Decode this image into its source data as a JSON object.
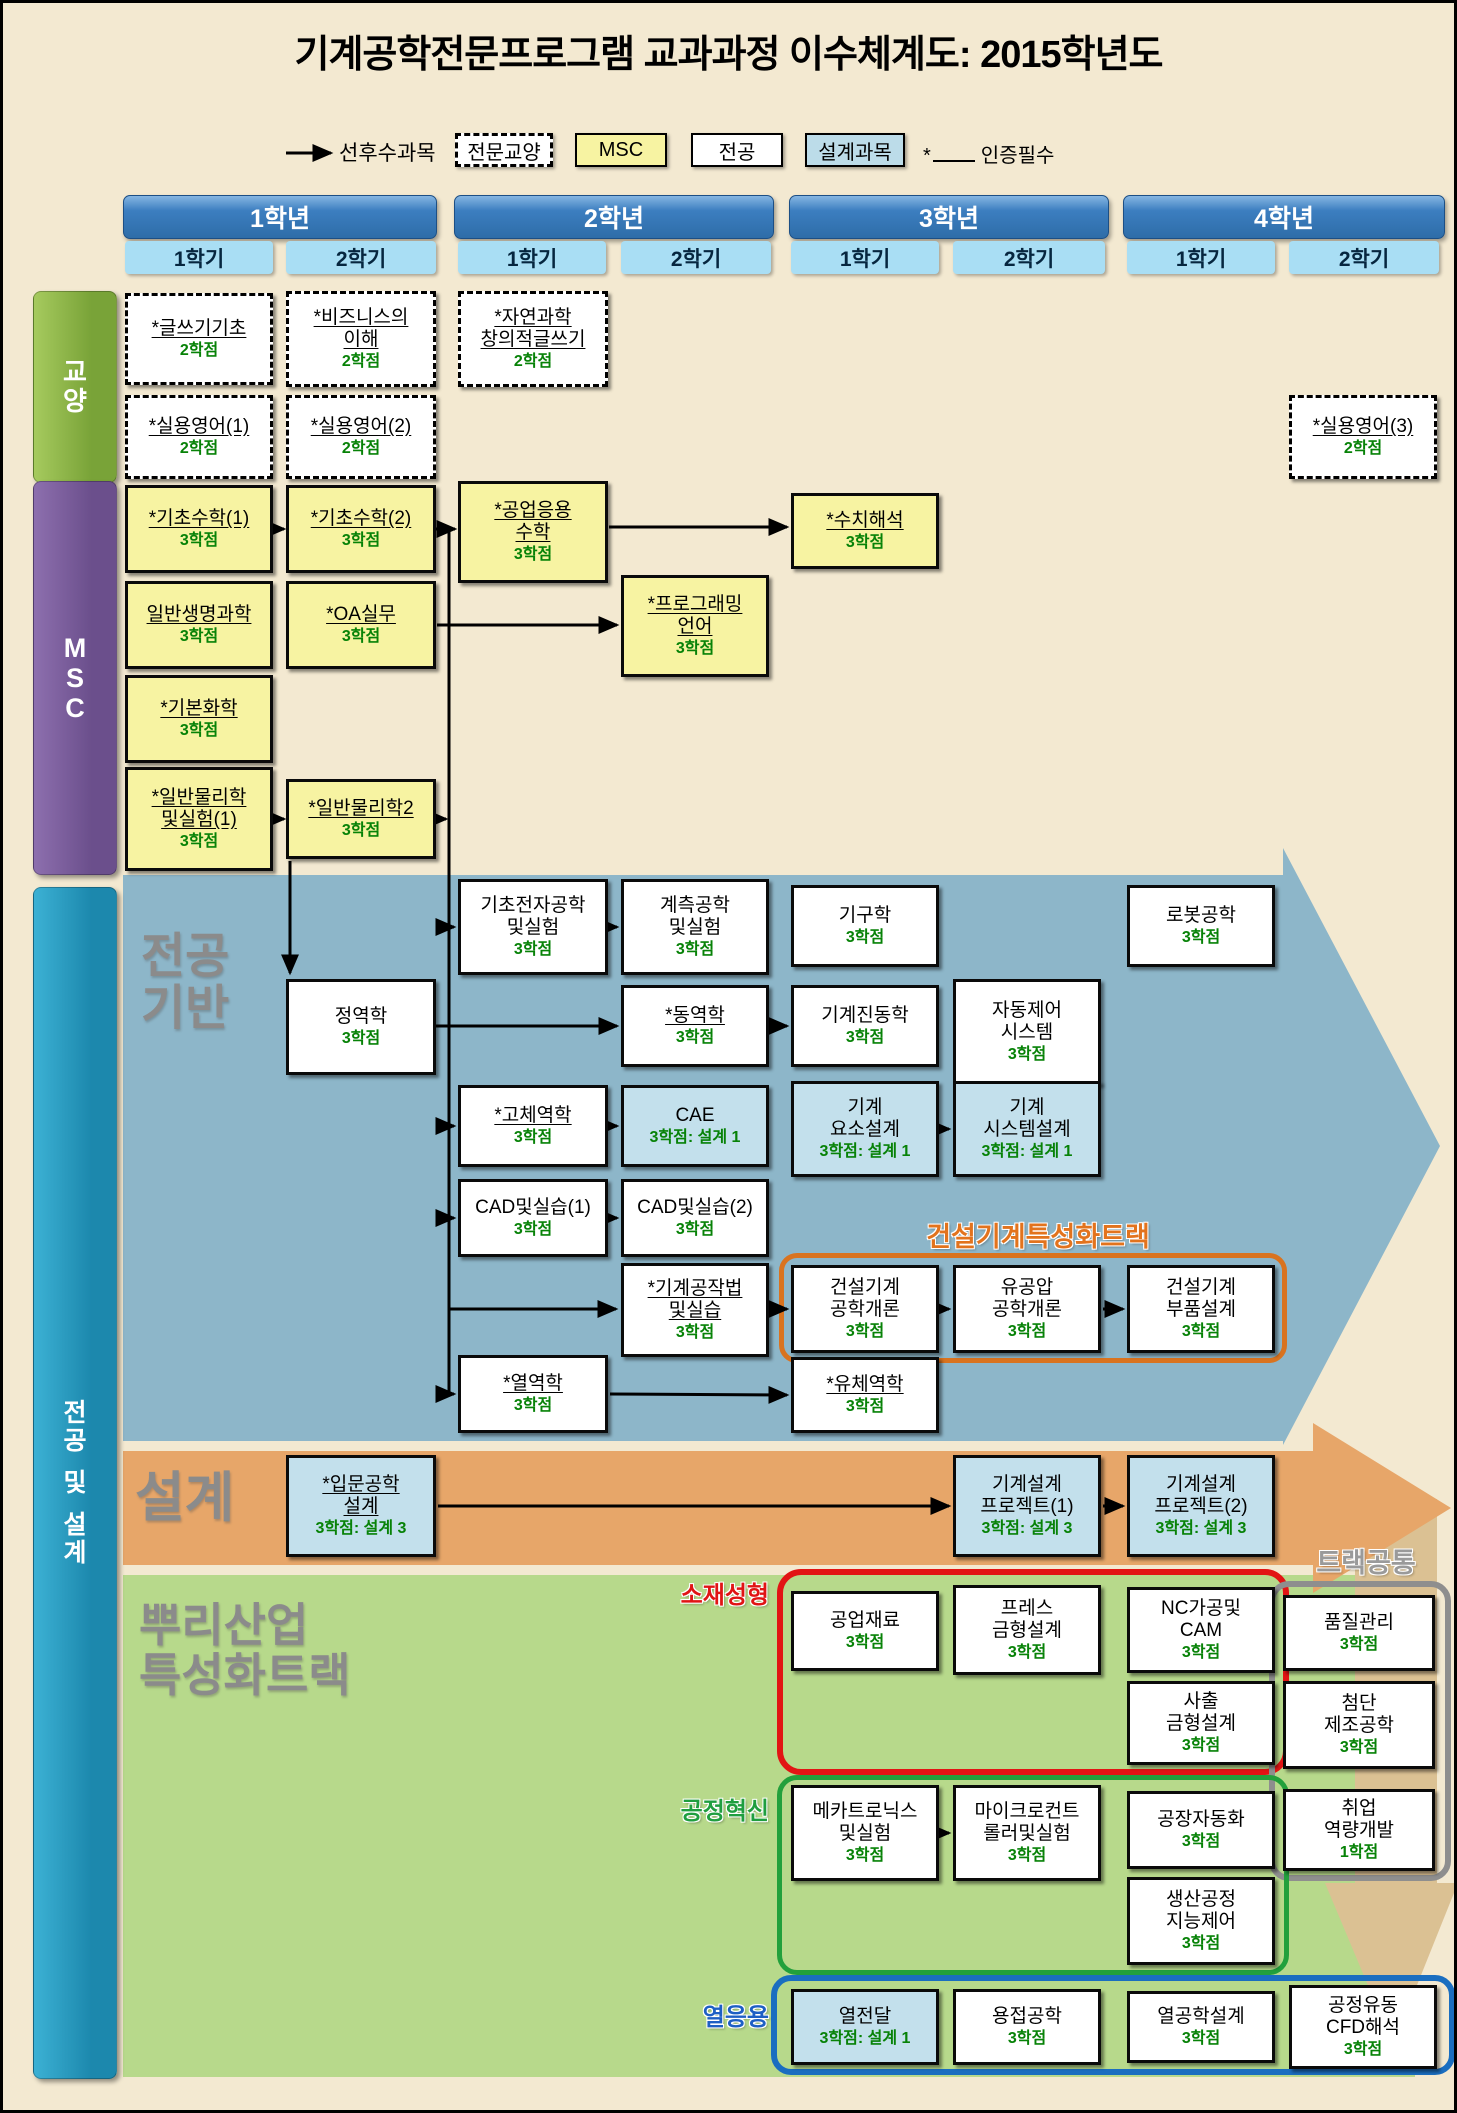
{
  "title": "기계공학전문프로그램 교과과정 이수체계도: 2015학년도",
  "legend": {
    "arrow_label": "선후수과목",
    "liberal": "전문교양",
    "msc": "MSC",
    "major": "전공",
    "design": "설계과목",
    "star": "*",
    "star_label": "인증필수"
  },
  "years": [
    {
      "label": "1학년",
      "semesters": [
        "1학기",
        "2학기"
      ]
    },
    {
      "label": "2학년",
      "semesters": [
        "1학기",
        "2학기"
      ]
    },
    {
      "label": "3학년",
      "semesters": [
        "1학기",
        "2학기"
      ]
    },
    {
      "label": "4학년",
      "semesters": [
        "1학기",
        "2학기"
      ]
    }
  ],
  "sidebar_bars": [
    {
      "id": "liberal",
      "label": "교양",
      "x": 30,
      "y": 288,
      "w": 82,
      "h": 190,
      "c1": "#a6ca5e",
      "c2": "#79a338",
      "size": 26
    },
    {
      "id": "msc",
      "label": "MSC",
      "x": 30,
      "y": 478,
      "w": 82,
      "h": 392,
      "c1": "#8d6fae",
      "c2": "#6b4f8c",
      "size": 27
    },
    {
      "id": "major-design",
      "label": "전공 및 설계",
      "x": 30,
      "y": 884,
      "w": 82,
      "h": 1190,
      "c1": "#3cb1d4",
      "c2": "#1c88ad",
      "size": 25
    }
  ],
  "sections": {
    "major_base": "전공\n기반",
    "design": "설계",
    "root_industry": "뿌리산업\n특성화트랙"
  },
  "track_labels": [
    {
      "id": "construction-track",
      "text": "건설기계특성화트랙",
      "x": 800,
      "y": 1212,
      "w": 470,
      "color": "#e2731d",
      "size": 27
    },
    {
      "id": "track-common",
      "text": "트랙공통",
      "x": 1278,
      "y": 1538,
      "w": 170,
      "color": "#9a9a9a",
      "size": 27
    },
    {
      "id": "material-forming",
      "text": "소재성형",
      "x": 628,
      "y": 1572,
      "w": 138,
      "color": "#e01414",
      "size": 24
    },
    {
      "id": "process-innovation",
      "text": "공정혁신",
      "x": 628,
      "y": 1788,
      "w": 138,
      "color": "#1f9e3f",
      "size": 24
    },
    {
      "id": "thermal-application",
      "text": "열응용",
      "x": 648,
      "y": 1994,
      "w": 118,
      "color": "#1d5fc4",
      "size": 24
    }
  ],
  "shapes": [
    {
      "name": "major-base-arrow",
      "points": "120,872 1280,872 1280,845 1437,1143 1280,1442 1280,1438 120,1438",
      "fill": "#8db6c9"
    },
    {
      "name": "root-industry-band",
      "points": "120,1572 1412,1572 1412,2074 120,2074",
      "fill": "#b7d98b"
    },
    {
      "name": "track-common-arrow",
      "points": "1352,1496 1434,1496 1434,1880 1455,1880 1390,2042 1322,1880 1352,1880",
      "fill": "#dbc193"
    },
    {
      "name": "design-arrow",
      "points": "120,1448 1310,1448 1310,1420 1448,1505 1310,1590 1310,1562 120,1562",
      "fill": "#e7a669"
    }
  ],
  "outline_rects": [
    {
      "id": "construction-track-rect",
      "x": 776,
      "y": 1250,
      "w": 508,
      "h": 110,
      "color": "#d9731f",
      "stroke": 5,
      "r": 18
    },
    {
      "id": "material-forming-rect",
      "x": 774,
      "y": 1566,
      "w": 512,
      "h": 206,
      "color": "#e21414",
      "stroke": 6,
      "r": 24
    },
    {
      "id": "track-common-rect",
      "x": 1266,
      "y": 1578,
      "w": 182,
      "h": 300,
      "color": "#8e8e8e",
      "stroke": 6,
      "r": 20
    },
    {
      "id": "process-innovation-rect",
      "x": 774,
      "y": 1772,
      "w": 512,
      "h": 200,
      "color": "#22a03c",
      "stroke": 5,
      "r": 20
    },
    {
      "id": "thermal-application-rect",
      "x": 768,
      "y": 1972,
      "w": 684,
      "h": 100,
      "color": "#1a6ec0",
      "stroke": 6,
      "r": 20
    }
  ],
  "courses": [
    {
      "id": "writing-basics",
      "name": "*글쓰기기초",
      "credit": "2학점",
      "type": "dashed",
      "u": true,
      "x": 122,
      "y": 290,
      "w": 148,
      "h": 92
    },
    {
      "id": "understanding-business",
      "name": "*비즈니스의\n이해",
      "credit": "2학점",
      "type": "dashed",
      "u": true,
      "x": 283,
      "y": 288,
      "w": 150,
      "h": 96
    },
    {
      "id": "natural-science-creative-writing",
      "name": "*자연과학\n창의적글쓰기",
      "credit": "2학점",
      "type": "dashed",
      "u": true,
      "x": 455,
      "y": 288,
      "w": 150,
      "h": 96
    },
    {
      "id": "practical-english-1",
      "name": "*실용영어(1)",
      "credit": "2학점",
      "type": "dashed",
      "u": true,
      "x": 122,
      "y": 392,
      "w": 148,
      "h": 84
    },
    {
      "id": "practical-english-2",
      "name": "*실용영어(2)",
      "credit": "2학점",
      "type": "dashed",
      "u": true,
      "x": 283,
      "y": 392,
      "w": 150,
      "h": 84
    },
    {
      "id": "practical-english-3",
      "name": "*실용영어(3)",
      "credit": "2학점",
      "type": "dashed",
      "u": true,
      "x": 1286,
      "y": 392,
      "w": 148,
      "h": 84
    },
    {
      "id": "basic-math-1",
      "name": "*기초수학(1)",
      "credit": "3학점",
      "type": "msc",
      "u": true,
      "x": 122,
      "y": 482,
      "w": 148,
      "h": 88
    },
    {
      "id": "basic-math-2",
      "name": "*기초수학(2)",
      "credit": "3학점",
      "type": "msc",
      "u": true,
      "x": 283,
      "y": 482,
      "w": 150,
      "h": 88
    },
    {
      "id": "engineering-applied-math",
      "name": "*공업응용\n수학",
      "credit": "3학점",
      "type": "msc",
      "u": true,
      "x": 455,
      "y": 478,
      "w": 150,
      "h": 102
    },
    {
      "id": "numerical-analysis",
      "name": "*수치해석",
      "credit": "3학점",
      "type": "msc",
      "u": true,
      "x": 788,
      "y": 490,
      "w": 148,
      "h": 76
    },
    {
      "id": "general-life-science",
      "name": "일반생명과학",
      "credit": "3학점",
      "type": "msc",
      "u": true,
      "x": 122,
      "y": 578,
      "w": 148,
      "h": 88
    },
    {
      "id": "oa-practice",
      "name": "*OA실무",
      "credit": "3학점",
      "type": "msc",
      "u": true,
      "x": 283,
      "y": 578,
      "w": 150,
      "h": 88
    },
    {
      "id": "programming-language",
      "name": "*프로그래밍\n언어",
      "credit": "3학점",
      "type": "msc",
      "u": true,
      "x": 618,
      "y": 572,
      "w": 148,
      "h": 102
    },
    {
      "id": "basic-chemistry",
      "name": "*기본화학",
      "credit": "3학점",
      "type": "msc",
      "u": true,
      "x": 122,
      "y": 672,
      "w": 148,
      "h": 88
    },
    {
      "id": "general-physics-lab-1",
      "name": "*일반물리학\n및실험(1)",
      "credit": "3학점",
      "type": "msc",
      "u": true,
      "x": 122,
      "y": 764,
      "w": 148,
      "h": 104
    },
    {
      "id": "general-physics-2",
      "name": "*일반물리학2",
      "credit": "3학점",
      "type": "msc",
      "u": true,
      "x": 283,
      "y": 776,
      "w": 150,
      "h": 80
    },
    {
      "id": "basic-electronics-lab",
      "name": "기초전자공학\n및실험",
      "credit": "3학점",
      "type": "major",
      "u": false,
      "x": 455,
      "y": 876,
      "w": 150,
      "h": 96
    },
    {
      "id": "instrumentation-lab",
      "name": "계측공학\n및실험",
      "credit": "3학점",
      "type": "major",
      "u": false,
      "x": 618,
      "y": 876,
      "w": 148,
      "h": 96
    },
    {
      "id": "mechanisms",
      "name": "기구학",
      "credit": "3학점",
      "type": "major",
      "u": false,
      "x": 788,
      "y": 882,
      "w": 148,
      "h": 82
    },
    {
      "id": "robotics",
      "name": "로봇공학",
      "credit": "3학점",
      "type": "major",
      "u": false,
      "x": 1124,
      "y": 882,
      "w": 148,
      "h": 82
    },
    {
      "id": "statics",
      "name": "정역학",
      "credit": "3학점",
      "type": "major",
      "u": false,
      "x": 283,
      "y": 976,
      "w": 150,
      "h": 96
    },
    {
      "id": "dynamics",
      "name": "*동역학",
      "credit": "3학점",
      "type": "major",
      "u": true,
      "x": 618,
      "y": 982,
      "w": 148,
      "h": 82
    },
    {
      "id": "mechanical-vibrations",
      "name": "기계진동학",
      "credit": "3학점",
      "type": "major",
      "u": false,
      "x": 788,
      "y": 982,
      "w": 148,
      "h": 82
    },
    {
      "id": "automatic-control-systems",
      "name": "자동제어\n시스템",
      "credit": "3학점",
      "type": "major",
      "u": false,
      "x": 950,
      "y": 976,
      "w": 148,
      "h": 106
    },
    {
      "id": "solid-mechanics",
      "name": "*고체역학",
      "credit": "3학점",
      "type": "major",
      "u": true,
      "x": 455,
      "y": 1082,
      "w": 150,
      "h": 82
    },
    {
      "id": "cae",
      "name": "CAE",
      "credit": "3학점: 설계 1",
      "type": "design",
      "u": false,
      "x": 618,
      "y": 1082,
      "w": 148,
      "h": 82
    },
    {
      "id": "machine-element-design",
      "name": "기계\n요소설계",
      "credit": "3학점: 설계 1",
      "type": "design",
      "u": false,
      "x": 788,
      "y": 1078,
      "w": 148,
      "h": 96
    },
    {
      "id": "machine-system-design",
      "name": "기계\n시스템설계",
      "credit": "3학점: 설계 1",
      "type": "design",
      "u": false,
      "x": 950,
      "y": 1078,
      "w": 148,
      "h": 96
    },
    {
      "id": "cad-practice-1",
      "name": "CAD및실습(1)",
      "credit": "3학점",
      "type": "major",
      "u": false,
      "x": 455,
      "y": 1176,
      "w": 150,
      "h": 78
    },
    {
      "id": "cad-practice-2",
      "name": "CAD및실습(2)",
      "credit": "3학점",
      "type": "major",
      "u": false,
      "x": 618,
      "y": 1176,
      "w": 148,
      "h": 78
    },
    {
      "id": "machine-shop-practice",
      "name": "*기계공작법\n및실습",
      "credit": "3학점",
      "type": "major",
      "u": true,
      "x": 618,
      "y": 1260,
      "w": 148,
      "h": 94
    },
    {
      "id": "construction-machinery-intro",
      "name": "건설기계\n공학개론",
      "credit": "3학점",
      "type": "major",
      "u": false,
      "x": 788,
      "y": 1262,
      "w": 148,
      "h": 88
    },
    {
      "id": "hydraulics-pneumatics-intro",
      "name": "유공압\n공학개론",
      "credit": "3학점",
      "type": "major",
      "u": false,
      "x": 950,
      "y": 1262,
      "w": 148,
      "h": 88
    },
    {
      "id": "construction-machinery-parts-design",
      "name": "건설기계\n부품설계",
      "credit": "3학점",
      "type": "major",
      "u": false,
      "x": 1124,
      "y": 1262,
      "w": 148,
      "h": 88
    },
    {
      "id": "thermodynamics",
      "name": "*열역학",
      "credit": "3학점",
      "type": "major",
      "u": true,
      "x": 455,
      "y": 1352,
      "w": 150,
      "h": 78
    },
    {
      "id": "fluid-mechanics",
      "name": "*유체역학",
      "credit": "3학점",
      "type": "major",
      "u": true,
      "x": 788,
      "y": 1354,
      "w": 148,
      "h": 76
    },
    {
      "id": "intro-engineering-design",
      "name": "*입문공학\n설계",
      "credit": "3학점: 설계 3",
      "type": "design",
      "u": true,
      "x": 283,
      "y": 1452,
      "w": 150,
      "h": 102
    },
    {
      "id": "machine-design-project-1",
      "name": "기계설계\n프로젝트(1)",
      "credit": "3학점: 설계 3",
      "type": "design",
      "u": false,
      "x": 950,
      "y": 1452,
      "w": 148,
      "h": 102
    },
    {
      "id": "machine-design-project-2",
      "name": "기계설계\n프로젝트(2)",
      "credit": "3학점: 설계 3",
      "type": "design",
      "u": false,
      "x": 1124,
      "y": 1452,
      "w": 148,
      "h": 102
    },
    {
      "id": "engineering-materials",
      "name": "공업재료",
      "credit": "3학점",
      "type": "major",
      "u": false,
      "x": 788,
      "y": 1588,
      "w": 148,
      "h": 80
    },
    {
      "id": "press-die-design",
      "name": "프레스\n금형설계",
      "credit": "3학점",
      "type": "major",
      "u": false,
      "x": 950,
      "y": 1582,
      "w": 148,
      "h": 90
    },
    {
      "id": "nc-machining-cam",
      "name": "NC가공및\nCAM",
      "credit": "3학점",
      "type": "major",
      "u": false,
      "x": 1124,
      "y": 1584,
      "w": 148,
      "h": 86
    },
    {
      "id": "injection-mold-design",
      "name": "사출\n금형설계",
      "credit": "3학점",
      "type": "major",
      "u": false,
      "x": 1124,
      "y": 1678,
      "w": 148,
      "h": 84
    },
    {
      "id": "quality-control",
      "name": "품질관리",
      "credit": "3학점",
      "type": "major",
      "u": false,
      "x": 1280,
      "y": 1592,
      "w": 152,
      "h": 76
    },
    {
      "id": "advanced-manufacturing",
      "name": "첨단\n제조공학",
      "credit": "3학점",
      "type": "major",
      "u": false,
      "x": 1280,
      "y": 1678,
      "w": 152,
      "h": 88
    },
    {
      "id": "career-competency",
      "name": "취업\n역량개발",
      "credit": "1학점",
      "type": "major",
      "u": false,
      "x": 1280,
      "y": 1786,
      "w": 152,
      "h": 82
    },
    {
      "id": "mechatronics-lab",
      "name": "메카트로닉스\n및실험",
      "credit": "3학점",
      "type": "major",
      "u": false,
      "x": 788,
      "y": 1782,
      "w": 148,
      "h": 96
    },
    {
      "id": "microcontroller-lab",
      "name": "마이크로컨트\n롤러및실험",
      "credit": "3학점",
      "type": "major",
      "u": false,
      "x": 950,
      "y": 1782,
      "w": 148,
      "h": 96
    },
    {
      "id": "factory-automation",
      "name": "공장자동화",
      "credit": "3학점",
      "type": "major",
      "u": false,
      "x": 1124,
      "y": 1788,
      "w": 148,
      "h": 78
    },
    {
      "id": "production-process-intelligent-control",
      "name": "생산공정\n지능제어",
      "credit": "3학점",
      "type": "major",
      "u": false,
      "x": 1124,
      "y": 1874,
      "w": 148,
      "h": 88
    },
    {
      "id": "heat-transfer",
      "name": "열전달",
      "credit": "3학점: 설계 1",
      "type": "design",
      "u": false,
      "x": 788,
      "y": 1986,
      "w": 148,
      "h": 76
    },
    {
      "id": "welding-engineering",
      "name": "용접공학",
      "credit": "3학점",
      "type": "major",
      "u": false,
      "x": 950,
      "y": 1986,
      "w": 148,
      "h": 76
    },
    {
      "id": "thermal-engineering-design",
      "name": "열공학설계",
      "credit": "3학점",
      "type": "major",
      "u": false,
      "x": 1124,
      "y": 1988,
      "w": 148,
      "h": 72
    },
    {
      "id": "process-flow-cfd",
      "name": "공정유동\nCFD해석",
      "credit": "3학점",
      "type": "major",
      "u": false,
      "x": 1286,
      "y": 1982,
      "w": 148,
      "h": 84
    }
  ],
  "connectors": [
    {
      "pts": [
        [
          283,
          150
        ],
        [
          328,
          150
        ]
      ],
      "arrow": true
    },
    {
      "pts": [
        [
          271,
          526
        ],
        [
          281,
          526
        ]
      ],
      "arrow": true
    },
    {
      "pts": [
        [
          433,
          526
        ],
        [
          452,
          526
        ]
      ],
      "arrow": true
    },
    {
      "pts": [
        [
          606,
          524
        ],
        [
          784,
          524
        ]
      ],
      "arrow": true
    },
    {
      "pts": [
        [
          434,
          622
        ],
        [
          614,
          622
        ]
      ],
      "arrow": true
    },
    {
      "pts": [
        [
          271,
          816
        ],
        [
          281,
          816
        ]
      ],
      "arrow": true
    },
    {
      "pts": [
        [
          435,
          816
        ],
        [
          443,
          816
        ]
      ],
      "arrow": true
    },
    {
      "pts": [
        [
          287,
          858
        ],
        [
          287,
          970
        ]
      ],
      "arrow": true
    },
    {
      "pts": [
        [
          446,
          526
        ],
        [
          446,
          1391
        ]
      ],
      "arrow": false
    },
    {
      "pts": [
        [
          446,
          924
        ],
        [
          451,
          924
        ]
      ],
      "arrow": true
    },
    {
      "pts": [
        [
          446,
          1123
        ],
        [
          451,
          1123
        ]
      ],
      "arrow": true
    },
    {
      "pts": [
        [
          446,
          1215
        ],
        [
          451,
          1215
        ]
      ],
      "arrow": true
    },
    {
      "pts": [
        [
          446,
          1306
        ],
        [
          613,
          1306
        ]
      ],
      "arrow": true
    },
    {
      "pts": [
        [
          446,
          1391
        ],
        [
          451,
          1391
        ]
      ],
      "arrow": true
    },
    {
      "pts": [
        [
          607,
          924
        ],
        [
          614,
          924
        ]
      ],
      "arrow": true
    },
    {
      "pts": [
        [
          433,
          1023
        ],
        [
          614,
          1023
        ]
      ],
      "arrow": true
    },
    {
      "pts": [
        [
          768,
          1023
        ],
        [
          784,
          1023
        ]
      ],
      "arrow": true
    },
    {
      "pts": [
        [
          606,
          1123
        ],
        [
          614,
          1123
        ]
      ],
      "arrow": true
    },
    {
      "pts": [
        [
          938,
          1126
        ],
        [
          946,
          1126
        ]
      ],
      "arrow": true
    },
    {
      "pts": [
        [
          607,
          1215
        ],
        [
          614,
          1215
        ]
      ],
      "arrow": true
    },
    {
      "pts": [
        [
          768,
          1306
        ],
        [
          784,
          1306
        ]
      ],
      "arrow": true
    },
    {
      "pts": [
        [
          938,
          1306
        ],
        [
          946,
          1306
        ]
      ],
      "arrow": true
    },
    {
      "pts": [
        [
          1100,
          1306
        ],
        [
          1120,
          1306
        ]
      ],
      "arrow": true
    },
    {
      "pts": [
        [
          607,
          1391
        ],
        [
          784,
          1392
        ]
      ],
      "arrow": true
    },
    {
      "pts": [
        [
          435,
          1503
        ],
        [
          946,
          1503
        ]
      ],
      "arrow": true
    },
    {
      "pts": [
        [
          1100,
          1503
        ],
        [
          1120,
          1503
        ]
      ],
      "arrow": true
    },
    {
      "pts": [
        [
          938,
          1830
        ],
        [
          946,
          1830
        ]
      ],
      "arrow": true
    }
  ],
  "colors": {
    "background": "#f3e9d1",
    "msc_box": "#f7f3a2",
    "design_box": "#c3e0ec",
    "credit_green": "#078207",
    "major_base_arrow": "#8db6c9",
    "design_arrow": "#e7a669",
    "root_band": "#b7d98b",
    "track_common_arrow": "#dbc193"
  }
}
